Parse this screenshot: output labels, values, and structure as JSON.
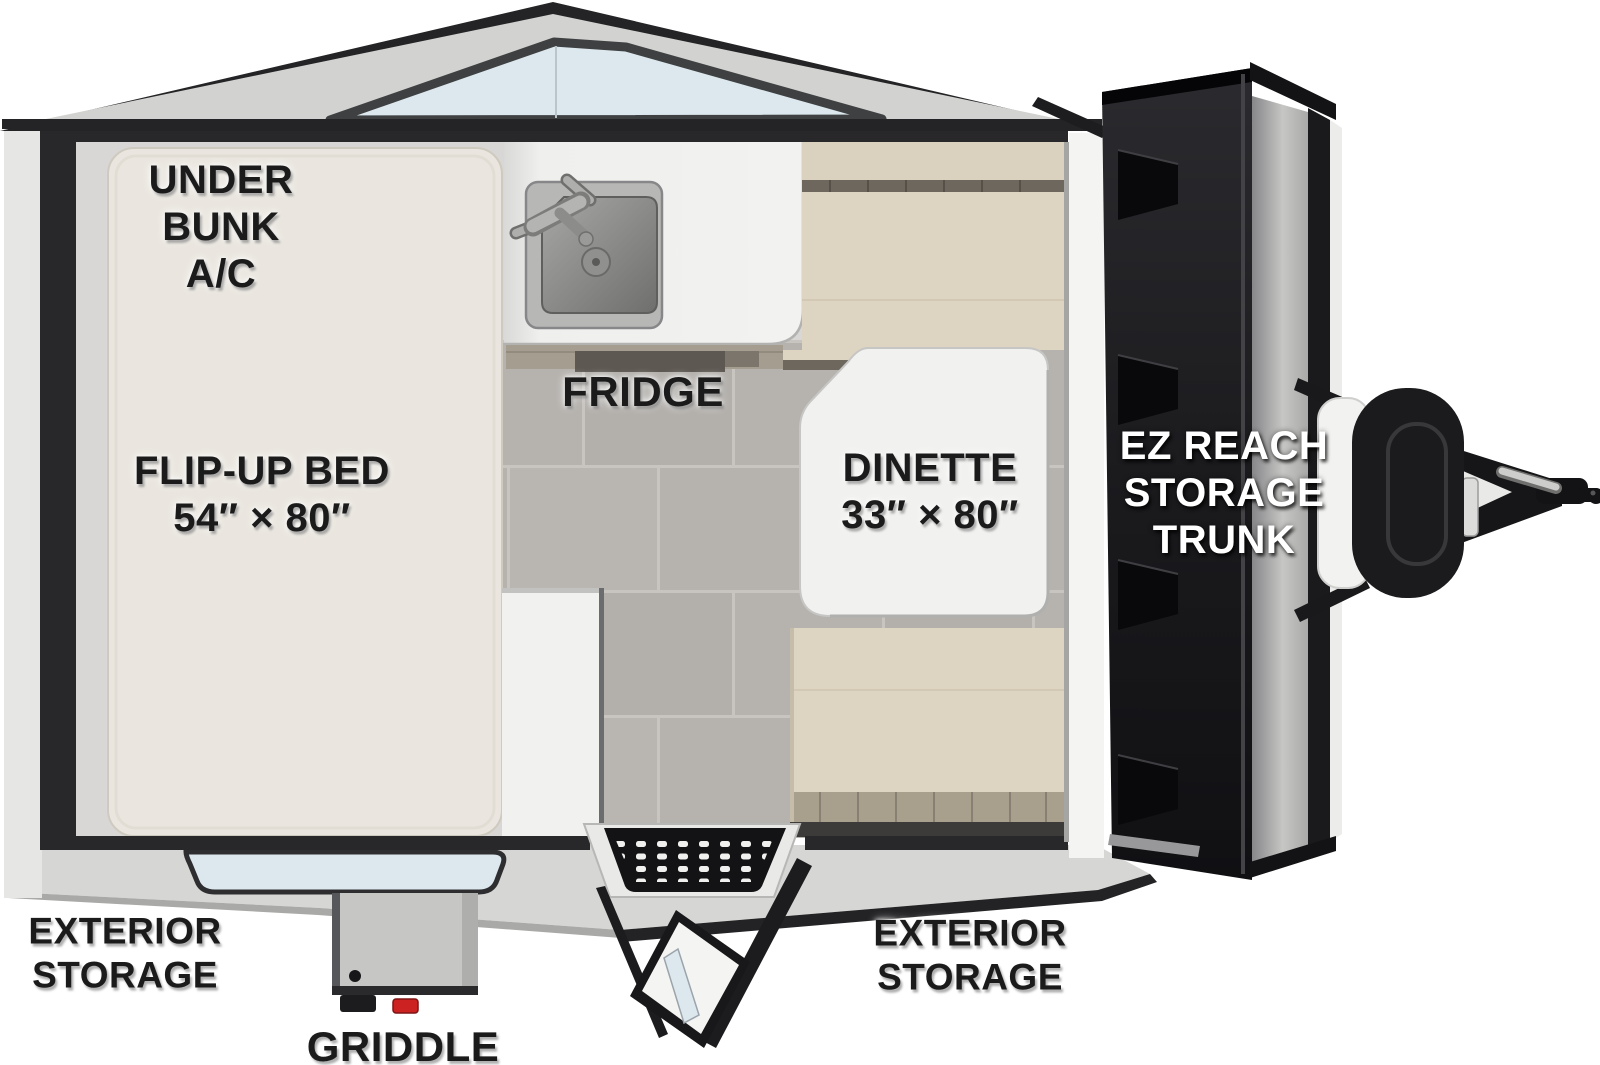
{
  "floorplan": {
    "type": "travel-trailer-floorplan",
    "labels": {
      "under_bunk_ac": "UNDER\nBUNK\nA/C",
      "flip_up_bed": "FLIP-UP BED\n54″ × 80″",
      "fridge": "FRIDGE",
      "dinette": "DINETTE\n33″ × 80″",
      "ez_reach_storage_trunk": "EZ REACH\nSTORAGE\nTRUNK",
      "exterior_storage_left": "EXTERIOR\nSTORAGE",
      "exterior_storage_right": "EXTERIOR\nSTORAGE",
      "griddle": "GRIDDLE"
    },
    "dimensions": {
      "flip_up_bed": "54″ × 80″",
      "dinette": "33″ × 80″"
    },
    "features": [
      "Flip-up bed",
      "Under bunk A/C",
      "Sink",
      "Fridge",
      "Dinette",
      "EZ Reach storage trunk",
      "Exterior storage (street side)",
      "Exterior storage (camp side)",
      "Griddle",
      "Entry door with step mat",
      "Front peak window",
      "Side window",
      "A-frame tongue with propane tank and coupler"
    ],
    "colors": {
      "wall_trim": "#28282a",
      "roof_shell": "#d2d2d0",
      "window_glass": "#dce8ee",
      "interior": "#d8d7d5",
      "bed_mattress": "#eae6df",
      "cushion_tan": "#ded4c2",
      "floor_tile": "#b6b3af",
      "table_white": "#f1f1ef",
      "trunk_door_black": "#1c1c1e",
      "griddle_valve_red": "#cc2222"
    }
  }
}
